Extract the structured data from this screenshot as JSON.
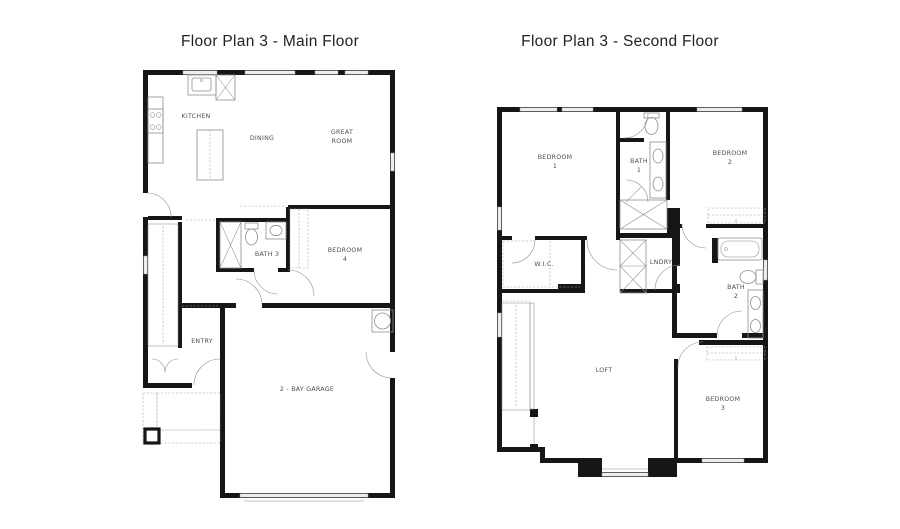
{
  "sheet": {
    "background": "#ffffff"
  },
  "colors": {
    "background": "#ffffff",
    "wall": "#161616",
    "fixture": "#8f8f8f",
    "dash": "#a8a8a8",
    "window_fill": "#ededed",
    "window_stroke": "#9c9c9c",
    "hatch": "#b0b0b0",
    "label": "#4f4f4f",
    "title": "#222222"
  },
  "main_floor": {
    "title": "Floor Plan 3 - Main Floor",
    "rooms": {
      "kitchen": "KITCHEN",
      "dining": "DINING",
      "great_room_1": "GREAT",
      "great_room_2": "ROOM",
      "bath": "BATH 3",
      "bedroom_1": "BEDROOM",
      "bedroom_2": "4",
      "entry": "ENTRY",
      "garage": "2 - BAY GARAGE"
    }
  },
  "second_floor": {
    "title": "Floor Plan 3 - Second Floor",
    "rooms": {
      "bedroom1_1": "BEDROOM",
      "bedroom1_2": "1",
      "bath1_1": "BATH",
      "bath1_2": "1",
      "bedroom2_1": "BEDROOM",
      "bedroom2_2": "2",
      "wic": "W.I.C.",
      "laundry": "LNDRY",
      "bath2_1": "BATH",
      "bath2_2": "2",
      "loft": "LOFT",
      "bedroom3_1": "BEDROOM",
      "bedroom3_2": "3"
    }
  }
}
